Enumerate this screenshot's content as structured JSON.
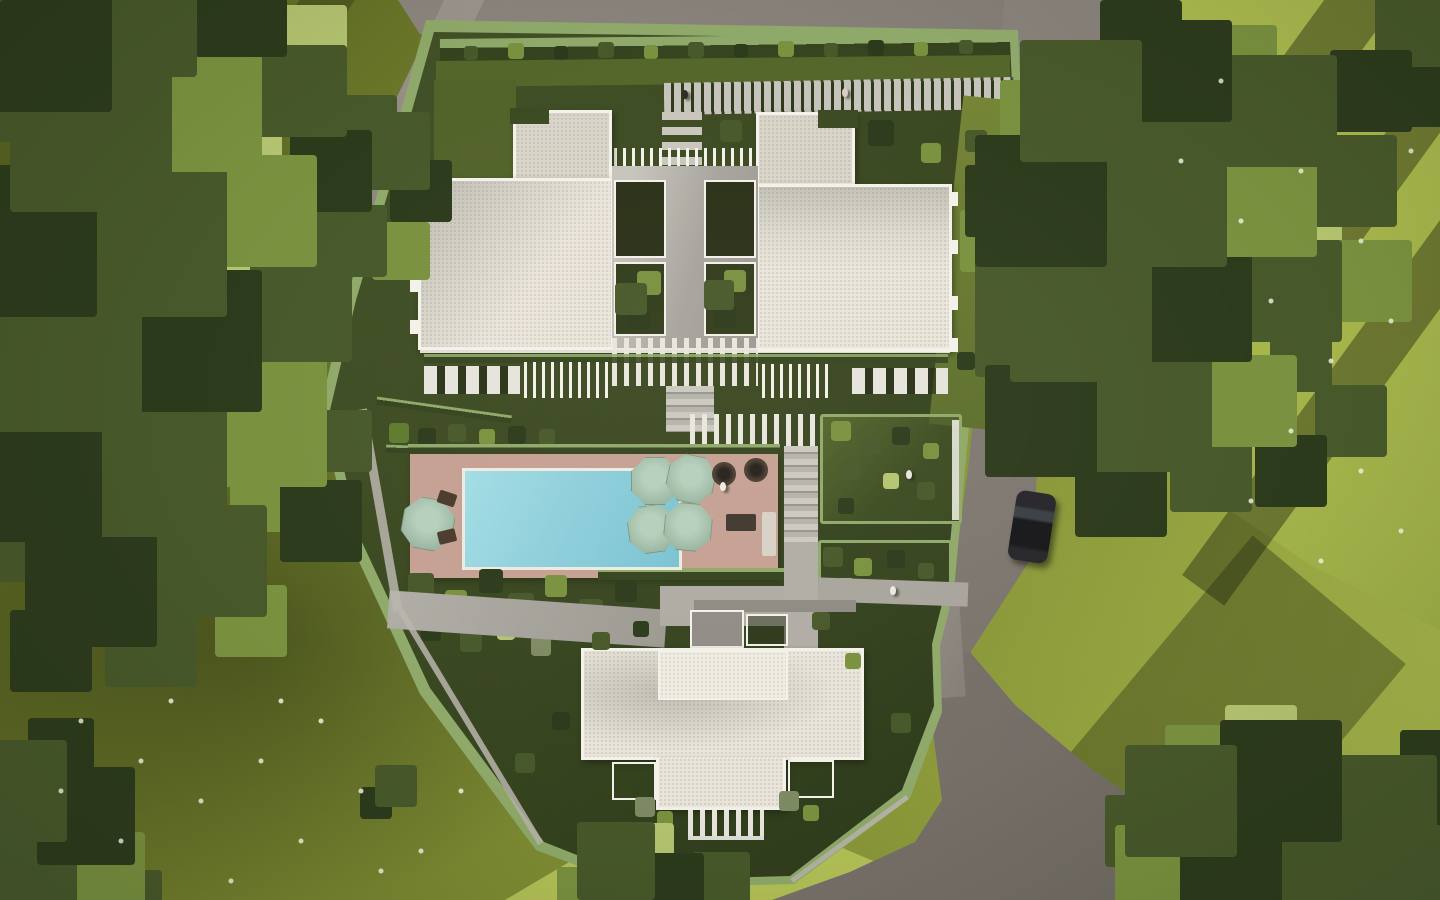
{
  "title": "aerial-render-residential-complex",
  "description": "Top-down architectural 3D rendering of a landscaped residential compound: three white flat-roofed buildings, central courtyard with pergola and stairs, swimming-pool terrace with five octagonal sage umbrellas and loungers, terraced garden beds, perimeter hedge walls, entry boardwalk, surrounding olive-green lawns with wildflowers, large tree canopies casting long shadows, asphalt access roads and one parked black car.",
  "palette": {
    "grass_base": "#76842f",
    "grass_bright": "#a9b84d",
    "grass_dark": "#55601f",
    "grass_sun": "#b9c65b",
    "tree_dark": "#2c3a1c",
    "tree_mid": "#47582a",
    "tree_light": "#79913f",
    "tree_hl": "#b4c470",
    "road": "#878179",
    "road_dark": "#6d6862",
    "path": "#b5b2aa",
    "roof": "#e9e5db",
    "roof_shade": "#d9d5c9",
    "parapet": "#f3f1ea",
    "pool": "#8ecfdc",
    "pool_deep": "#79c2d2",
    "deck": "#c5a093",
    "umbrella": "#a0bca8",
    "hedge": "#35431f",
    "hedge_light": "#8fa96a",
    "garden": "#3c4a22",
    "car": "#17171b",
    "flower": "#f3f5e2"
  },
  "scene": {
    "buildings": [
      {
        "name": "building-north-west",
        "roof": "white gravel flat roof with raised stair-core block"
      },
      {
        "name": "building-north-east",
        "roof": "white gravel flat roof with notched stair-core block"
      },
      {
        "name": "building-south",
        "roof": "white T-shaped flat roof with pergola terrace"
      }
    ],
    "pool": {
      "shape": "rectangular",
      "water_color": "#8ecfdc",
      "deck": "wood planks"
    },
    "umbrellas": {
      "count": 5,
      "shape": "octagonal",
      "color": "#a0bca8"
    },
    "loungers": {
      "count": 2,
      "color": "#382f27"
    },
    "car": {
      "count": 1,
      "color": "#17171b",
      "location": "east road"
    },
    "people_visible": 5,
    "roads": [
      "north access lane",
      "east road curving to south-east"
    ],
    "landscape": [
      "perimeter hedge wall",
      "terraced garden beds",
      "shrub garden",
      "boardwalk entry with slatted paving",
      "large tree canopies",
      "lawns with white wildflowers",
      "long evening shadows"
    ]
  }
}
